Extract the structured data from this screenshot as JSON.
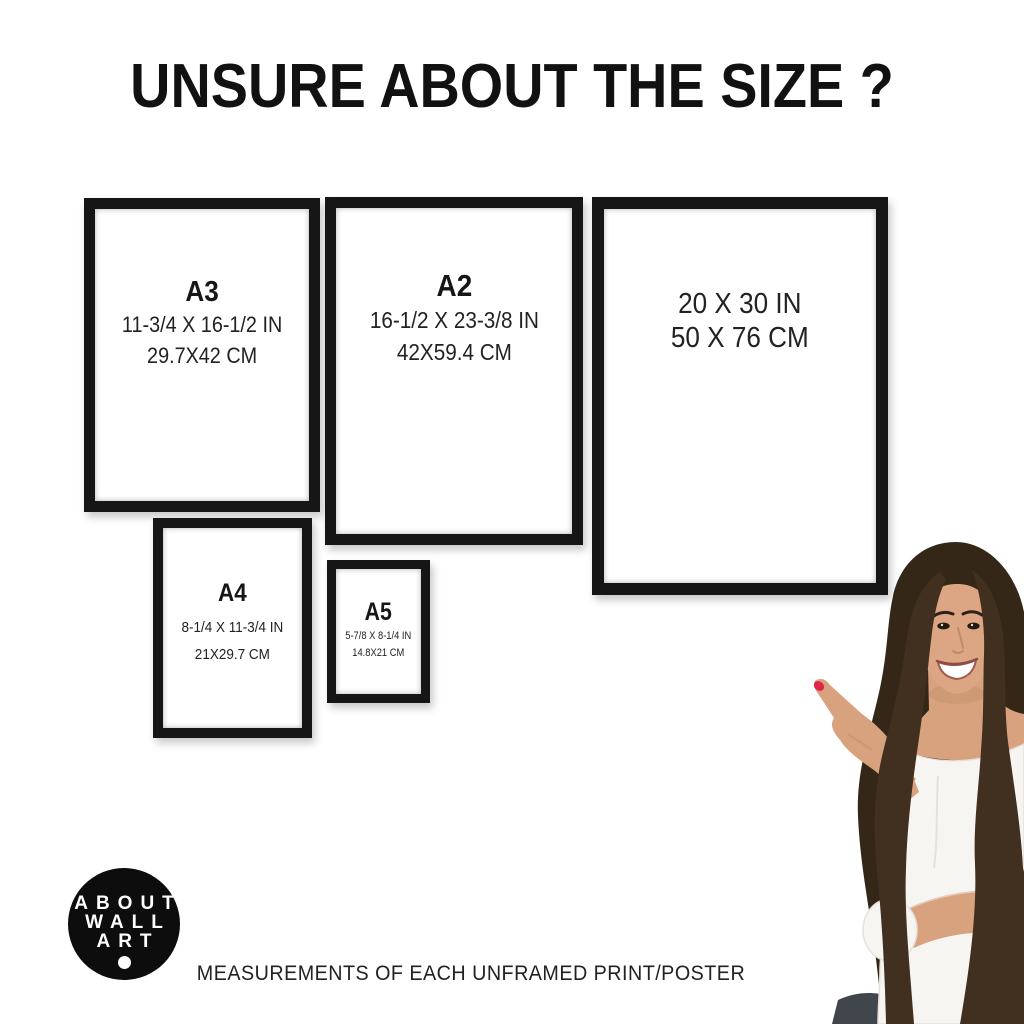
{
  "title": "UNSURE ABOUT THE SIZE ?",
  "frames": {
    "a3": {
      "name": "A3",
      "inches": "11-3/4 X 16-1/2 IN",
      "cm": "29.7X42 CM"
    },
    "a2": {
      "name": "A2",
      "inches": "16-1/2 X 23-3/8 IN",
      "cm": "42X59.4 CM"
    },
    "s2030": {
      "inches": "20 X 30 IN",
      "cm": "50 X 76 CM"
    },
    "a4": {
      "name": "A4",
      "inches": "8-1/4 X 11-3/4 IN",
      "cm": "21X29.7 CM"
    },
    "a5": {
      "name": "A5",
      "inches": "5-7/8 X 8-1/4 IN",
      "cm": "14.8X21 CM"
    }
  },
  "logo": {
    "line1": "ABOUT",
    "line2": "WALL",
    "line3": "ART"
  },
  "caption": "MEASUREMENTS OF EACH UNFRAMED PRINT/POSTER",
  "colors": {
    "background": "#ffffff",
    "ink": "#1a1a1a",
    "frame": "#161616",
    "logo_bg": "#0d0d0d",
    "hair": "#352718",
    "hair_light": "#41301f",
    "skin": "#d8a27f",
    "shirt": "#f7f5f2",
    "nail": "#e02648",
    "jeans": "#41464c"
  }
}
